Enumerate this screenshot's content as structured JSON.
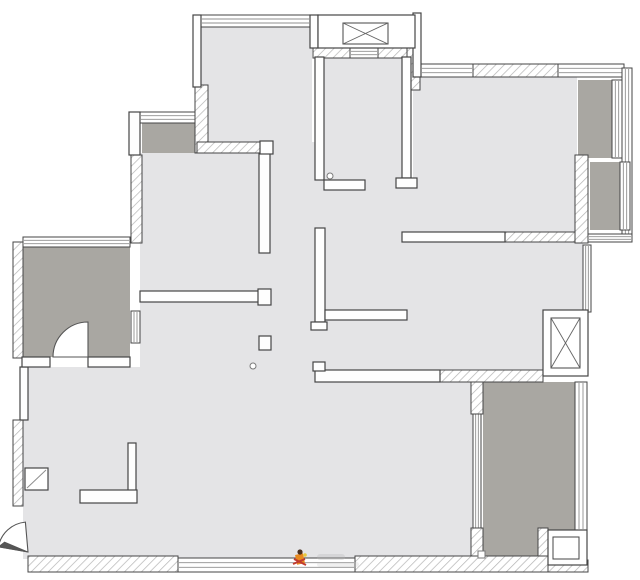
{
  "canvas": {
    "width": 640,
    "height": 580,
    "background": "#ffffff"
  },
  "colors": {
    "floor": "#e4e4e6",
    "balcony": "#a9a7a2",
    "wall_fill": "#fefefe",
    "wall_stroke": "#454545",
    "hatch_line": "#b3b3b3",
    "window_line": "#8f8f8f",
    "x_line": "#666666",
    "door_stroke": "#555555",
    "marker_stroke": "#7a7a7a"
  },
  "plan": {
    "floors": [
      {
        "name": "top-left-bedroom-floor",
        "rect": [
          200,
          25,
          112,
          118
        ],
        "tone": "floor"
      },
      {
        "name": "elevator-lobby-floor",
        "rect": [
          323,
          57,
          80,
          133
        ],
        "tone": "floor"
      },
      {
        "name": "hallway-floor",
        "rect": [
          271,
          142,
          52,
          226
        ],
        "tone": "floor"
      },
      {
        "name": "center-area-floor",
        "rect": [
          323,
          187,
          92,
          183
        ],
        "tone": "floor"
      },
      {
        "name": "left-bedroom-floor",
        "rect": [
          140,
          153,
          131,
          139
        ],
        "tone": "floor"
      },
      {
        "name": "bathroom-floor",
        "rect": [
          140,
          302,
          131,
          66
        ],
        "tone": "floor"
      },
      {
        "name": "top-right-bedroom-floor",
        "rect": [
          413,
          77,
          164,
          157
        ],
        "tone": "floor"
      },
      {
        "name": "right-bedroom-floor",
        "rect": [
          403,
          230,
          180,
          142
        ],
        "tone": "floor"
      },
      {
        "name": "living-dining-floor",
        "rect": [
          23,
          367,
          452,
          192
        ],
        "tone": "floor"
      },
      {
        "name": "left-bay-window-floor",
        "rect": [
          142,
          122,
          53,
          31
        ],
        "tone": "balcony"
      },
      {
        "name": "left-balcony-floor",
        "rect": [
          22,
          247,
          108,
          110
        ],
        "tone": "balcony"
      },
      {
        "name": "right-closet-strip-floor",
        "rect": [
          578,
          80,
          34,
          78
        ],
        "tone": "balcony"
      },
      {
        "name": "right-platform-floor",
        "rect": [
          590,
          162,
          30,
          68
        ],
        "tone": "balcony"
      },
      {
        "name": "bottom-right-balcony-floor",
        "rect": [
          483,
          382,
          92,
          178
        ],
        "tone": "balcony"
      }
    ],
    "windows": [
      [
        201,
        15,
        109,
        12
      ],
      [
        421,
        64,
        52,
        13
      ],
      [
        558,
        64,
        66,
        13
      ],
      [
        622,
        68,
        10,
        172
      ],
      [
        612,
        80,
        10,
        78
      ],
      [
        620,
        162,
        10,
        68
      ],
      [
        583,
        245,
        8,
        67
      ],
      [
        588,
        234,
        44,
        8
      ],
      [
        575,
        382,
        12,
        148
      ],
      [
        473,
        411,
        8,
        119
      ],
      [
        23,
        237,
        107,
        10
      ],
      [
        131,
        311,
        9,
        32
      ],
      [
        140,
        112,
        57,
        11
      ],
      [
        178,
        558,
        177,
        14
      ],
      [
        350,
        48,
        28,
        10
      ]
    ],
    "hatch_walls": [
      [
        195,
        85,
        13,
        68
      ],
      [
        197,
        142,
        65,
        11
      ],
      [
        131,
        155,
        11,
        88
      ],
      [
        313,
        48,
        37,
        10
      ],
      [
        378,
        48,
        37,
        10
      ],
      [
        407,
        47,
        13,
        43
      ],
      [
        473,
        64,
        85,
        13
      ],
      [
        575,
        155,
        13,
        88
      ],
      [
        503,
        232,
        72,
        10
      ],
      [
        13,
        242,
        10,
        116
      ],
      [
        13,
        420,
        10,
        86
      ],
      [
        440,
        370,
        103,
        12
      ],
      [
        471,
        382,
        12,
        32
      ],
      [
        471,
        528,
        12,
        32
      ],
      [
        538,
        528,
        10,
        34
      ],
      [
        28,
        556,
        150,
        16
      ],
      [
        355,
        556,
        193,
        16
      ],
      [
        548,
        560,
        40,
        12
      ]
    ],
    "solid_walls": [
      [
        193,
        15,
        8,
        72
      ],
      [
        129,
        112,
        11,
        43
      ],
      [
        310,
        15,
        8,
        33
      ],
      [
        413,
        13,
        8,
        64
      ],
      [
        315,
        57,
        9,
        123
      ],
      [
        324,
        180,
        41,
        10
      ],
      [
        402,
        57,
        9,
        121
      ],
      [
        396,
        178,
        21,
        10
      ],
      [
        259,
        153,
        11,
        100
      ],
      [
        140,
        291,
        120,
        11
      ],
      [
        258,
        289,
        13,
        16
      ],
      [
        259,
        336,
        12,
        14
      ],
      [
        260,
        141,
        13,
        13
      ],
      [
        315,
        228,
        10,
        94
      ],
      [
        311,
        322,
        16,
        8
      ],
      [
        325,
        310,
        82,
        10
      ],
      [
        402,
        232,
        103,
        10
      ],
      [
        315,
        370,
        125,
        12
      ],
      [
        313,
        362,
        12,
        9
      ],
      [
        128,
        443,
        8,
        48
      ],
      [
        80,
        490,
        57,
        13
      ],
      [
        20,
        367,
        8,
        53
      ],
      [
        22,
        357,
        28,
        10
      ],
      [
        88,
        357,
        42,
        10
      ]
    ],
    "elevators": [
      {
        "name": "elevator-shaft-top",
        "box": [
          318,
          15,
          97,
          33
        ],
        "cab": [
          343,
          23,
          45,
          21
        ]
      },
      {
        "name": "elevator-shaft-right",
        "box": [
          543,
          310,
          45,
          66
        ],
        "cab": [
          551,
          318,
          29,
          50
        ]
      }
    ],
    "fixtures": [
      {
        "name": "ac-platform",
        "outer": [
          548,
          530,
          39,
          35
        ],
        "inner": [
          553,
          537,
          26,
          22
        ]
      },
      {
        "name": "entry-cabinet",
        "outer": [
          25,
          468,
          23,
          22
        ],
        "diag": [
          27,
          488,
          46,
          470
        ]
      }
    ],
    "doors": [
      {
        "name": "balcony-door",
        "hinge": [
          88,
          357
        ],
        "r": 35,
        "start": -90,
        "end": 180,
        "wedge": false
      },
      {
        "name": "entry-door",
        "hinge": [
          28,
          552
        ],
        "r": 30,
        "start": 265,
        "end": 190,
        "wedge": true
      }
    ],
    "markers": [
      {
        "shape": "circle",
        "cx": 330,
        "cy": 176,
        "r": 3
      },
      {
        "shape": "circle",
        "cy": 366,
        "cx": 253,
        "r": 3
      },
      {
        "shape": "square",
        "x": 478,
        "y": 551,
        "s": 7
      }
    ],
    "watermark": {
      "x": 293,
      "y": 546,
      "head_color": "#4a3020",
      "body_color": "#e8891f",
      "cross_color": "#c03b30",
      "dot_color": "#e8c83c",
      "text_blob_color": "#b9b9b9"
    }
  }
}
